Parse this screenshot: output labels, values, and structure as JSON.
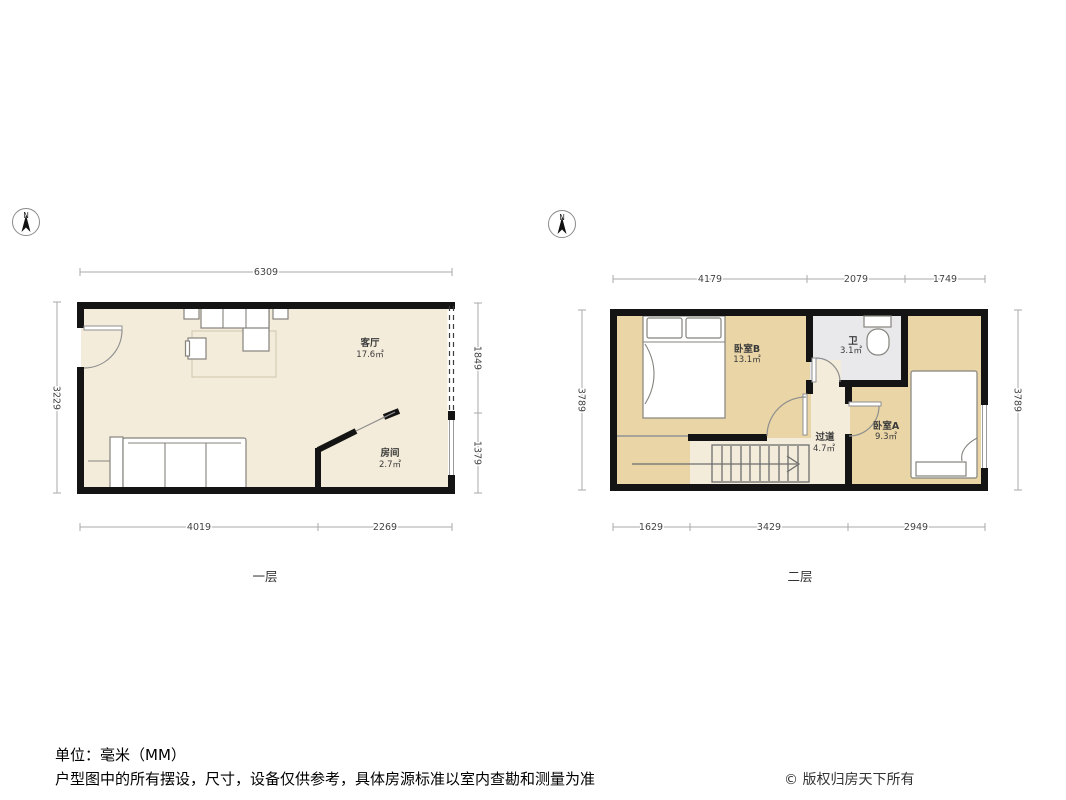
{
  "colors": {
    "wall": "#141414",
    "floor_cream": "#f4ecda",
    "bedroom_tan": "#e9d5a6",
    "bathroom_gray": "#e9e9ec",
    "furniture_stroke": "#85837c",
    "dim_line": "#aaaaaa",
    "dim_text": "#444444"
  },
  "floor1": {
    "name": "一层",
    "compass_label": "N",
    "dimensions": {
      "top": [
        "6309"
      ],
      "bottom": [
        "4019",
        "2269"
      ],
      "left": [
        "3229"
      ],
      "right": [
        "1849",
        "1379"
      ]
    },
    "rooms": [
      {
        "name": "客厅",
        "area": "17.6㎡"
      },
      {
        "name": "房间",
        "area": "2.7㎡"
      }
    ]
  },
  "floor2": {
    "name": "二层",
    "compass_label": "N",
    "dimensions": {
      "top": [
        "4179",
        "2079",
        "1749"
      ],
      "bottom": [
        "1629",
        "3429",
        "2949"
      ],
      "left": [
        "3789"
      ],
      "right": [
        "3789"
      ]
    },
    "rooms": [
      {
        "name": "卧室B",
        "area": "13.1㎡"
      },
      {
        "name": "卫",
        "area": "3.1㎡"
      },
      {
        "name": "过道",
        "area": "4.7㎡"
      },
      {
        "name": "卧室A",
        "area": "9.3㎡"
      }
    ]
  },
  "footer": {
    "unit_label": "单位：毫米（MM）",
    "disclaimer": "户型图中的所有摆设，尺寸，设备仅供参考，具体房源标准以室内查勘和测量为准",
    "copyright": "© 版权归房天下所有"
  }
}
